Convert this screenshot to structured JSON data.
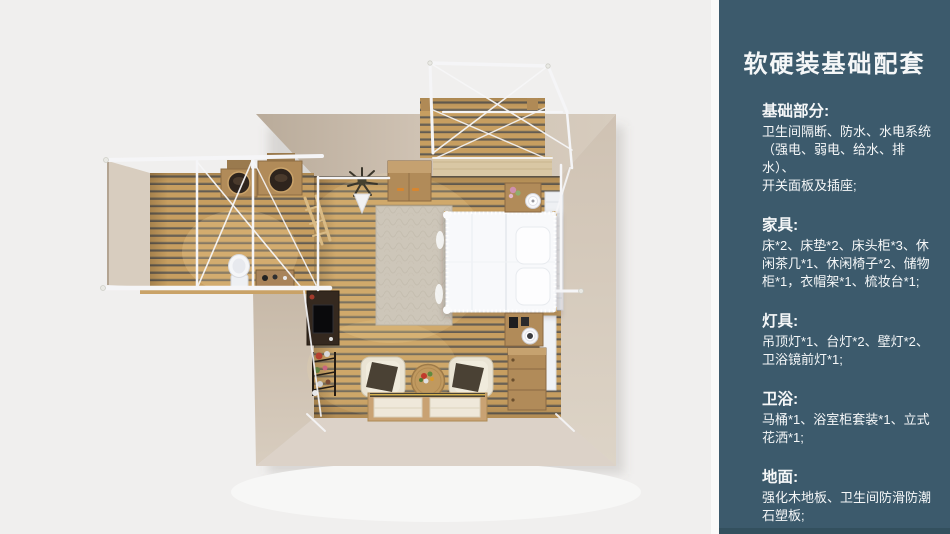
{
  "page": {
    "background": "#f0efee",
    "width": 950,
    "height": 534
  },
  "sidebar": {
    "title": "软硬装基础配套",
    "colors": {
      "background": "#3c5a6c",
      "bottom_strip": "#33505e",
      "text": "#f5f7f8"
    },
    "sections": [
      {
        "heading": "基础部分:",
        "body": "卫生间隔断、防水、水电系统\n（强电、弱电、给水、排水）、\n开关面板及插座;"
      },
      {
        "heading": "家具:",
        "body": "床*2、床垫*2、床头柜*3、休\n闲茶几*1、休闲椅子*2、储物\n柜*1，衣帽架*1、梳妆台*1;"
      },
      {
        "heading": "灯具:",
        "body": "吊顶灯*1、台灯*2、壁灯*2、\n卫浴镜前灯*1;"
      },
      {
        "heading": "卫浴:",
        "body": "马桶*1、浴室柜套装*1、立式\n花洒*1;"
      },
      {
        "heading": "地面:",
        "body": "强化木地板、卫生间防滑防潮\n石塑板;"
      }
    ]
  },
  "floorplan": {
    "description": "top-down 3D render of a tent-frame suite: bedroom with canopy bed, attached bathroom with double vanity and toilet, front entry deck with white canopy frame",
    "rooms": [
      "bedroom",
      "bathroom",
      "entry-deck"
    ],
    "furniture": [
      "canopy-bed",
      "rug",
      "wardrobe-cabinet",
      "nightstand",
      "table-lamp",
      "dresser",
      "tv-desk",
      "flower-rack",
      "armchair",
      "coffee-table",
      "tatami-platform",
      "vanity-basin",
      "toilet",
      "coat-rack-plant",
      "headboard-panel"
    ],
    "colors": {
      "wall_light": "#dcd2c8",
      "wall_mid": "#d3c6b7",
      "wall_dark": "#bcae9d",
      "bath_wall": "#d8cdbf",
      "wood_plank": "#c79e60",
      "wood_gap": "#635c52",
      "threshold": "#d9c7a4",
      "frame_white": "#f5f5f7",
      "bed_white": "#f8f9fb",
      "rug": "#cdc6b9",
      "furniture_wood": "#b18b59",
      "dark_furniture": "#35291f",
      "platform_wood": "#c9a273",
      "mat": "#efe8da",
      "basin_dark": "#2e241d"
    }
  }
}
